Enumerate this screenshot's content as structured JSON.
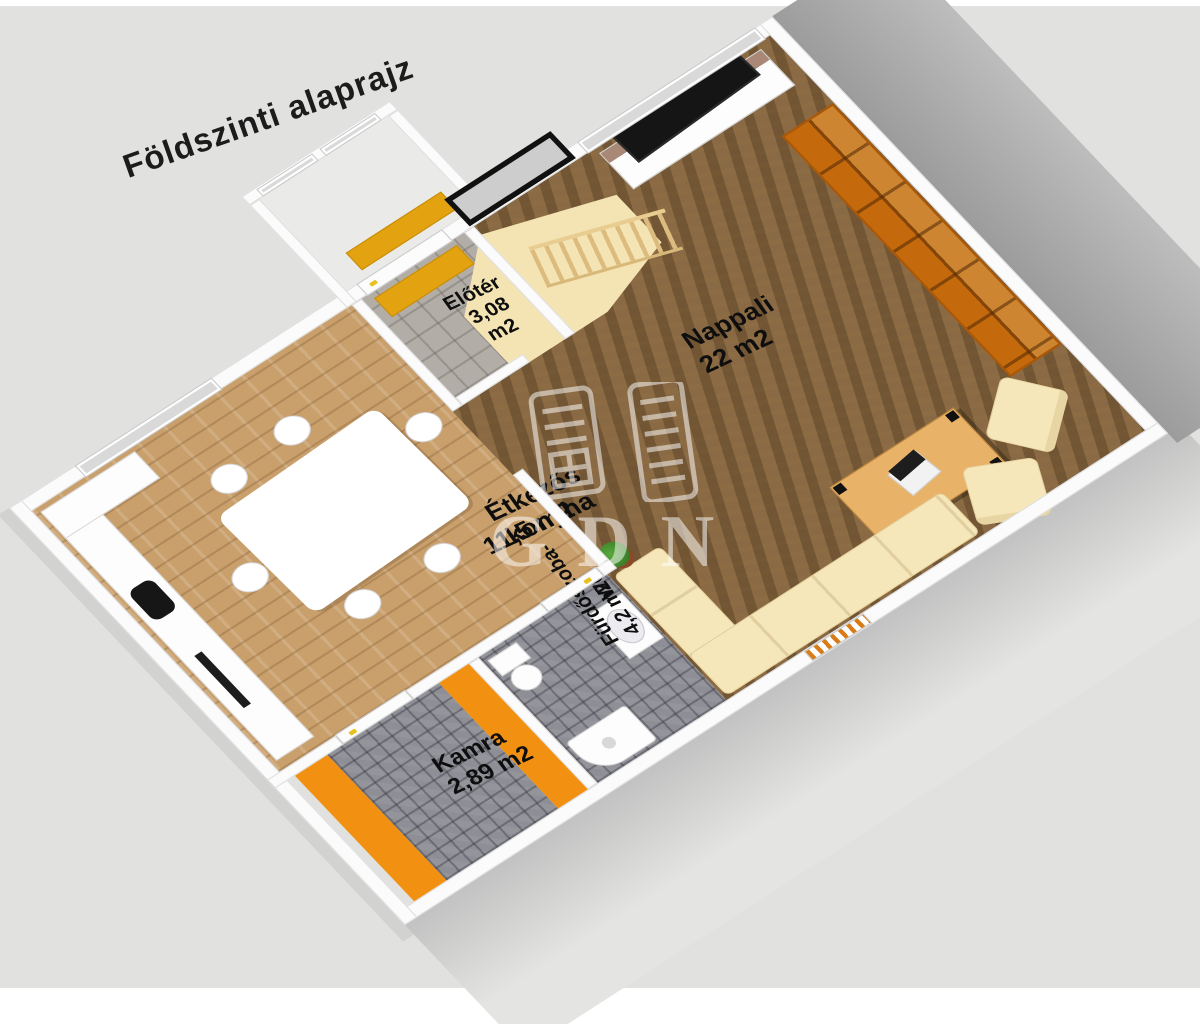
{
  "title": "Földszinti alaprajz",
  "watermark": {
    "text": "GDN"
  },
  "rooms": [
    {
      "id": "elotor",
      "name": "Előtér",
      "area": "3,08 m2"
    },
    {
      "id": "nappali",
      "name": "Nappali",
      "area": "22 m2"
    },
    {
      "id": "etkezo",
      "name": "Étkezős konyha",
      "area": "11,5 m2"
    },
    {
      "id": "furdo",
      "name": "Fürdőszoba-WC",
      "area": "4,2 m2"
    },
    {
      "id": "kamra",
      "name": "Kamra",
      "area": "2,89 m2"
    }
  ],
  "colors": {
    "background": "#e1e1df",
    "orange": "#f29111",
    "doormat": "#e3a20f",
    "wood_dark": "#8a6a44",
    "wood_light": "#c9a06c",
    "tile_grey": "#8e8e96",
    "wardrobe": "#c4690c",
    "cream": "#f6e7ba",
    "wall": "#fbfbfb"
  }
}
